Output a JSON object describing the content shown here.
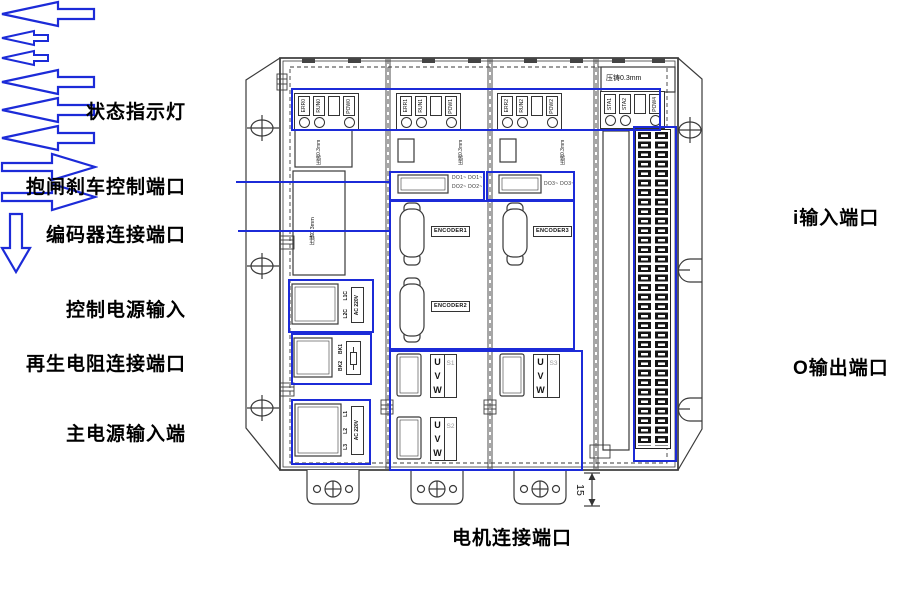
{
  "colors": {
    "highlight": "#1c2bd8",
    "line": "#3a3a3a"
  },
  "labels": {
    "status": "状态指示灯",
    "brake": "抱闸刹车控制端口",
    "encoder": "编码器连接端口",
    "control_power": "控制电源输入",
    "regen_resistor": "再生电阻连接端口",
    "main_power": "主电源输入端",
    "input_port": "i输入端口",
    "output_port": "O输出端口",
    "motor_port": "电机连接端口"
  },
  "device": {
    "led_groups": [
      {
        "labels": [
          "ERR0",
          "RUN0",
          "POW0"
        ]
      },
      {
        "labels": [
          "ERR1",
          "RUN1",
          "POW1"
        ]
      },
      {
        "labels": [
          "ERR2",
          "RUN2",
          "POW2"
        ]
      },
      {
        "labels": [
          "STA1",
          "STA2",
          "POW4"
        ]
      }
    ],
    "diecast": "压铸0.3mm",
    "do": {
      "m2_line1": "DO1~ DO1~",
      "m2_line2": "DO2~ DO2~",
      "m3": "DO3~ DO3~"
    },
    "encoders": [
      "ENCODER1",
      "ENCODER2",
      "ENCODER3"
    ],
    "uvw": {
      "u": "U",
      "v": "V",
      "w": "W",
      "s": [
        "S1",
        "S2",
        "S3"
      ]
    },
    "power": {
      "l1c": "L1C",
      "l2c": "L2C",
      "ac220": "AC 220V",
      "bk1": "BK1",
      "bk2": "BK2",
      "l1": "L1",
      "l2": "L2",
      "l3": "L3"
    },
    "dimension": "15"
  }
}
